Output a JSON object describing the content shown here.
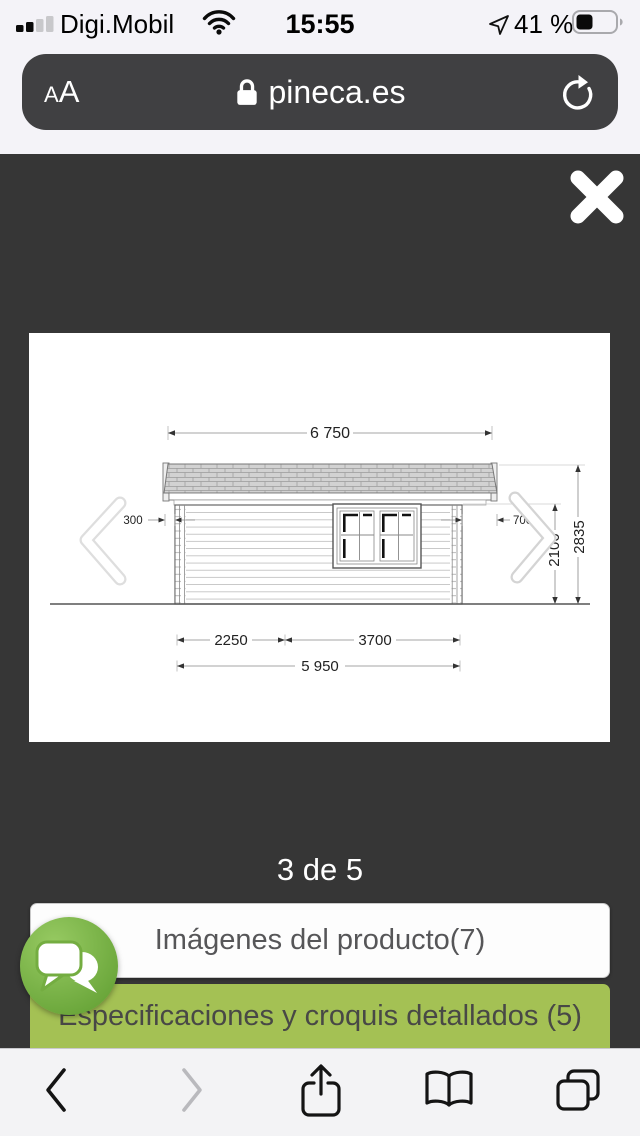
{
  "status_bar": {
    "carrier": "Digi.Mobil",
    "time": "15:55",
    "battery_percent": "41 %"
  },
  "url_bar": {
    "reader_small": "A",
    "reader_large": "A",
    "domain": "pineca.es"
  },
  "lightbox": {
    "pagination": "3 de 5"
  },
  "drawing": {
    "width_total": "6 750",
    "overhang_left": "300",
    "overhang_right": "700",
    "height_total": "2835",
    "height_wall": "2100",
    "bottom_left": "2250",
    "bottom_right": "3700",
    "bottom_total": "5 950"
  },
  "actions": {
    "images_button": "Imágenes del producto(7)",
    "specs_button": "Especificaciones y croquis detallados (5)"
  },
  "colors": {
    "accent_green": "#a4c154",
    "chat_green": "#74ad41",
    "overlay": "#363636"
  }
}
